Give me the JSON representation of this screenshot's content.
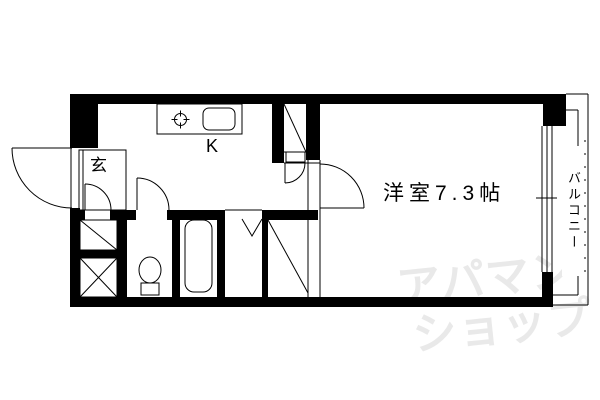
{
  "floorplan": {
    "labels": {
      "genkan": "玄",
      "kitchen": "K",
      "room": "洋室7.3帖",
      "balcony": "バルコニー"
    },
    "watermark": {
      "line1": "アパマン",
      "line2": "ショップ",
      "color": "#e9e9e9"
    },
    "colors": {
      "wall": "#000000",
      "line": "#000000",
      "background": "#ffffff"
    }
  }
}
